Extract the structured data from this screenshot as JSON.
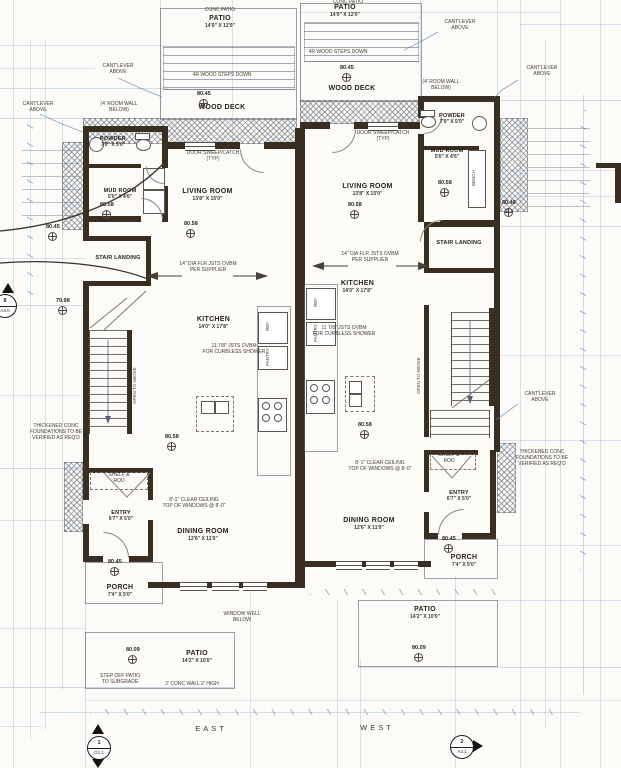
{
  "colors": {
    "wall": "#3a2d21",
    "dimension_line": "#4a7fb5",
    "hatch": "#6e7680",
    "ink": "#2b2721"
  },
  "compass": {
    "east": "EAST",
    "west": "WEST"
  },
  "markers": {
    "left": {
      "number": "8",
      "sheet": "A3.0"
    },
    "bottom_left": {
      "number": "1",
      "sheet": "G1.1"
    },
    "bottom_right": {
      "number": "2",
      "sheet": "A3.1"
    }
  },
  "elevations": {
    "deck": "80.45",
    "main": "80.58",
    "stair": "79.98",
    "patio": "80.09",
    "east_side": "80.48"
  },
  "rooms": {
    "patio_nw": {
      "name": "PATIO",
      "dims": "14'0\" X 12'0\""
    },
    "patio_ne": {
      "name": "PATIO",
      "dims": "14'0\" X 12'0\""
    },
    "wood_deck_w": {
      "name": "WOOD DECK"
    },
    "wood_deck_e": {
      "name": "WOOD DECK"
    },
    "powder_w": {
      "name": "POWDER",
      "dims": "7'0\" X 5'0\""
    },
    "powder_e": {
      "name": "POWDER",
      "dims": "7'0\" X 5'0\""
    },
    "mud_w": {
      "name": "MUD ROOM",
      "dims": "5'0\" X 4'6\""
    },
    "mud_e": {
      "name": "MUD ROOM",
      "dims": "5'0\" X 4'6\""
    },
    "living_w": {
      "name": "LIVING ROOM",
      "dims": "13'8\" X 15'0\""
    },
    "living_e": {
      "name": "LIVING ROOM",
      "dims": "13'8\" X 15'0\""
    },
    "kitchen_w": {
      "name": "KITCHEN",
      "dims": "14'0\" X 17'8\""
    },
    "kitchen_e": {
      "name": "KITCHEN",
      "dims": "14'0\" X 17'8\""
    },
    "landing_w": {
      "name": "STAIR LANDING"
    },
    "landing_e": {
      "name": "STAIR LANDING"
    },
    "dining_w": {
      "name": "DINING ROOM",
      "dims": "12'6\" X 11'0\""
    },
    "dining_e": {
      "name": "DINING ROOM",
      "dims": "12'6\" X 11'0\""
    },
    "entry_w": {
      "name": "ENTRY",
      "dims": "6'7\" X 5'0\""
    },
    "entry_e": {
      "name": "ENTRY",
      "dims": "6'7\" X 5'0\""
    },
    "porch_w": {
      "name": "PORCH",
      "dims": "7'4\" X 5'0\""
    },
    "porch_e": {
      "name": "PORCH",
      "dims": "7'4\" X 5'0\""
    },
    "patio_sw": {
      "name": "PATIO",
      "dims": "14'2\" X 10'0\""
    },
    "patio_se": {
      "name": "PATIO",
      "dims": "14'2\" X 10'0\""
    }
  },
  "notes": {
    "conc_patio": "CONC PATIO",
    "steps": "4R WOOD STEPS DOWN",
    "cantilever": "CANT'LEVER\nABOVE",
    "door_sweep": "DOOR SWEEP/CATCH (TYP)",
    "wall_below": "(4' ROOM WALL BELOW)",
    "joists": "14\" DIA FLR JSTS OVBM\nPER SUPPLIER",
    "curbless": "11 7/8\" JSTS OVBM\nFOR CURBLESS SHOWER",
    "open_above": "OPEN TO ABOVE",
    "ref": "REF",
    "pantry": "PANTRY",
    "bench": "BENCH",
    "shelf_rod": "SHELF &\nROD",
    "clear_ceiling": "8'-1\" CLEAR CEILING\nTOP OF WINDOWS @ 8'-0\"",
    "thickened": "THICKENED CONC\nFOUNDATIONS TO BE\nVERIFIED AS REQ'D",
    "window_well": "WINDOW WELL\nBELOW",
    "step_off": "STEP OFF PATIO\nTO SUBGRADE",
    "conc_wall": "2' CONC WALL 2' HIGH"
  }
}
